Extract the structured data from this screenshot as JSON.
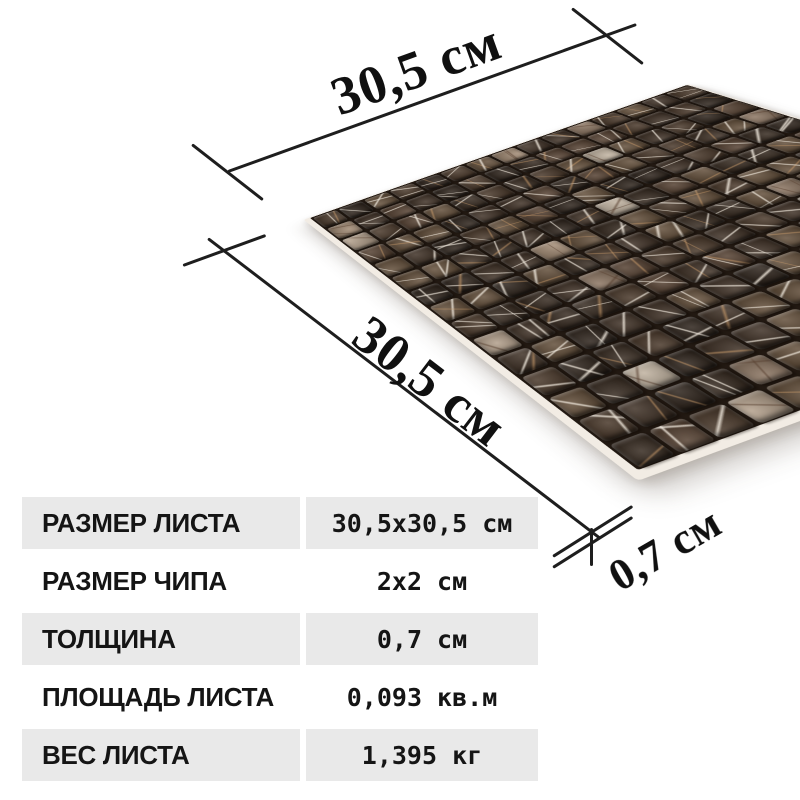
{
  "dimensions": {
    "top_width_label": "30,5 см",
    "left_height_label": "30,5 см",
    "thickness_label": "0,7 см"
  },
  "spec_table": {
    "rows": [
      {
        "label": "РАЗМЕР ЛИСТА",
        "value": "30,5x30,5 см"
      },
      {
        "label": "РАЗМЕР ЧИПА",
        "value": "2x2 см"
      },
      {
        "label": "ТОЛЩИНА",
        "value": "0,7 см"
      },
      {
        "label": "ПЛОЩАДЬ ЛИСТА",
        "value": "0,093 кв.м"
      },
      {
        "label": "ВЕС ЛИСТА",
        "value": "1,395 кг"
      }
    ]
  },
  "mosaic": {
    "rows": 15,
    "cols": 15,
    "seed": 11,
    "palette_dark": [
      "#2f251d",
      "#382c22",
      "#413328",
      "#4b3a2c",
      "#564233",
      "#64503c"
    ],
    "palette_light": [
      "#a18a74",
      "#b3a08c",
      "#8c7663",
      "#c0b2a0"
    ],
    "vein_light": "rgba(236,228,216,0.85)",
    "vein_warm": "rgba(200,154,106,0.6)",
    "vein_dark": "rgba(90,66,50,0.6)",
    "grout_color": "#221912",
    "backing_color": "#f2ece4"
  },
  "colors": {
    "table_row_bg": "#e9e9e9",
    "text": "#151515",
    "dimension_line": "#1e1e1e",
    "background": "#ffffff"
  }
}
